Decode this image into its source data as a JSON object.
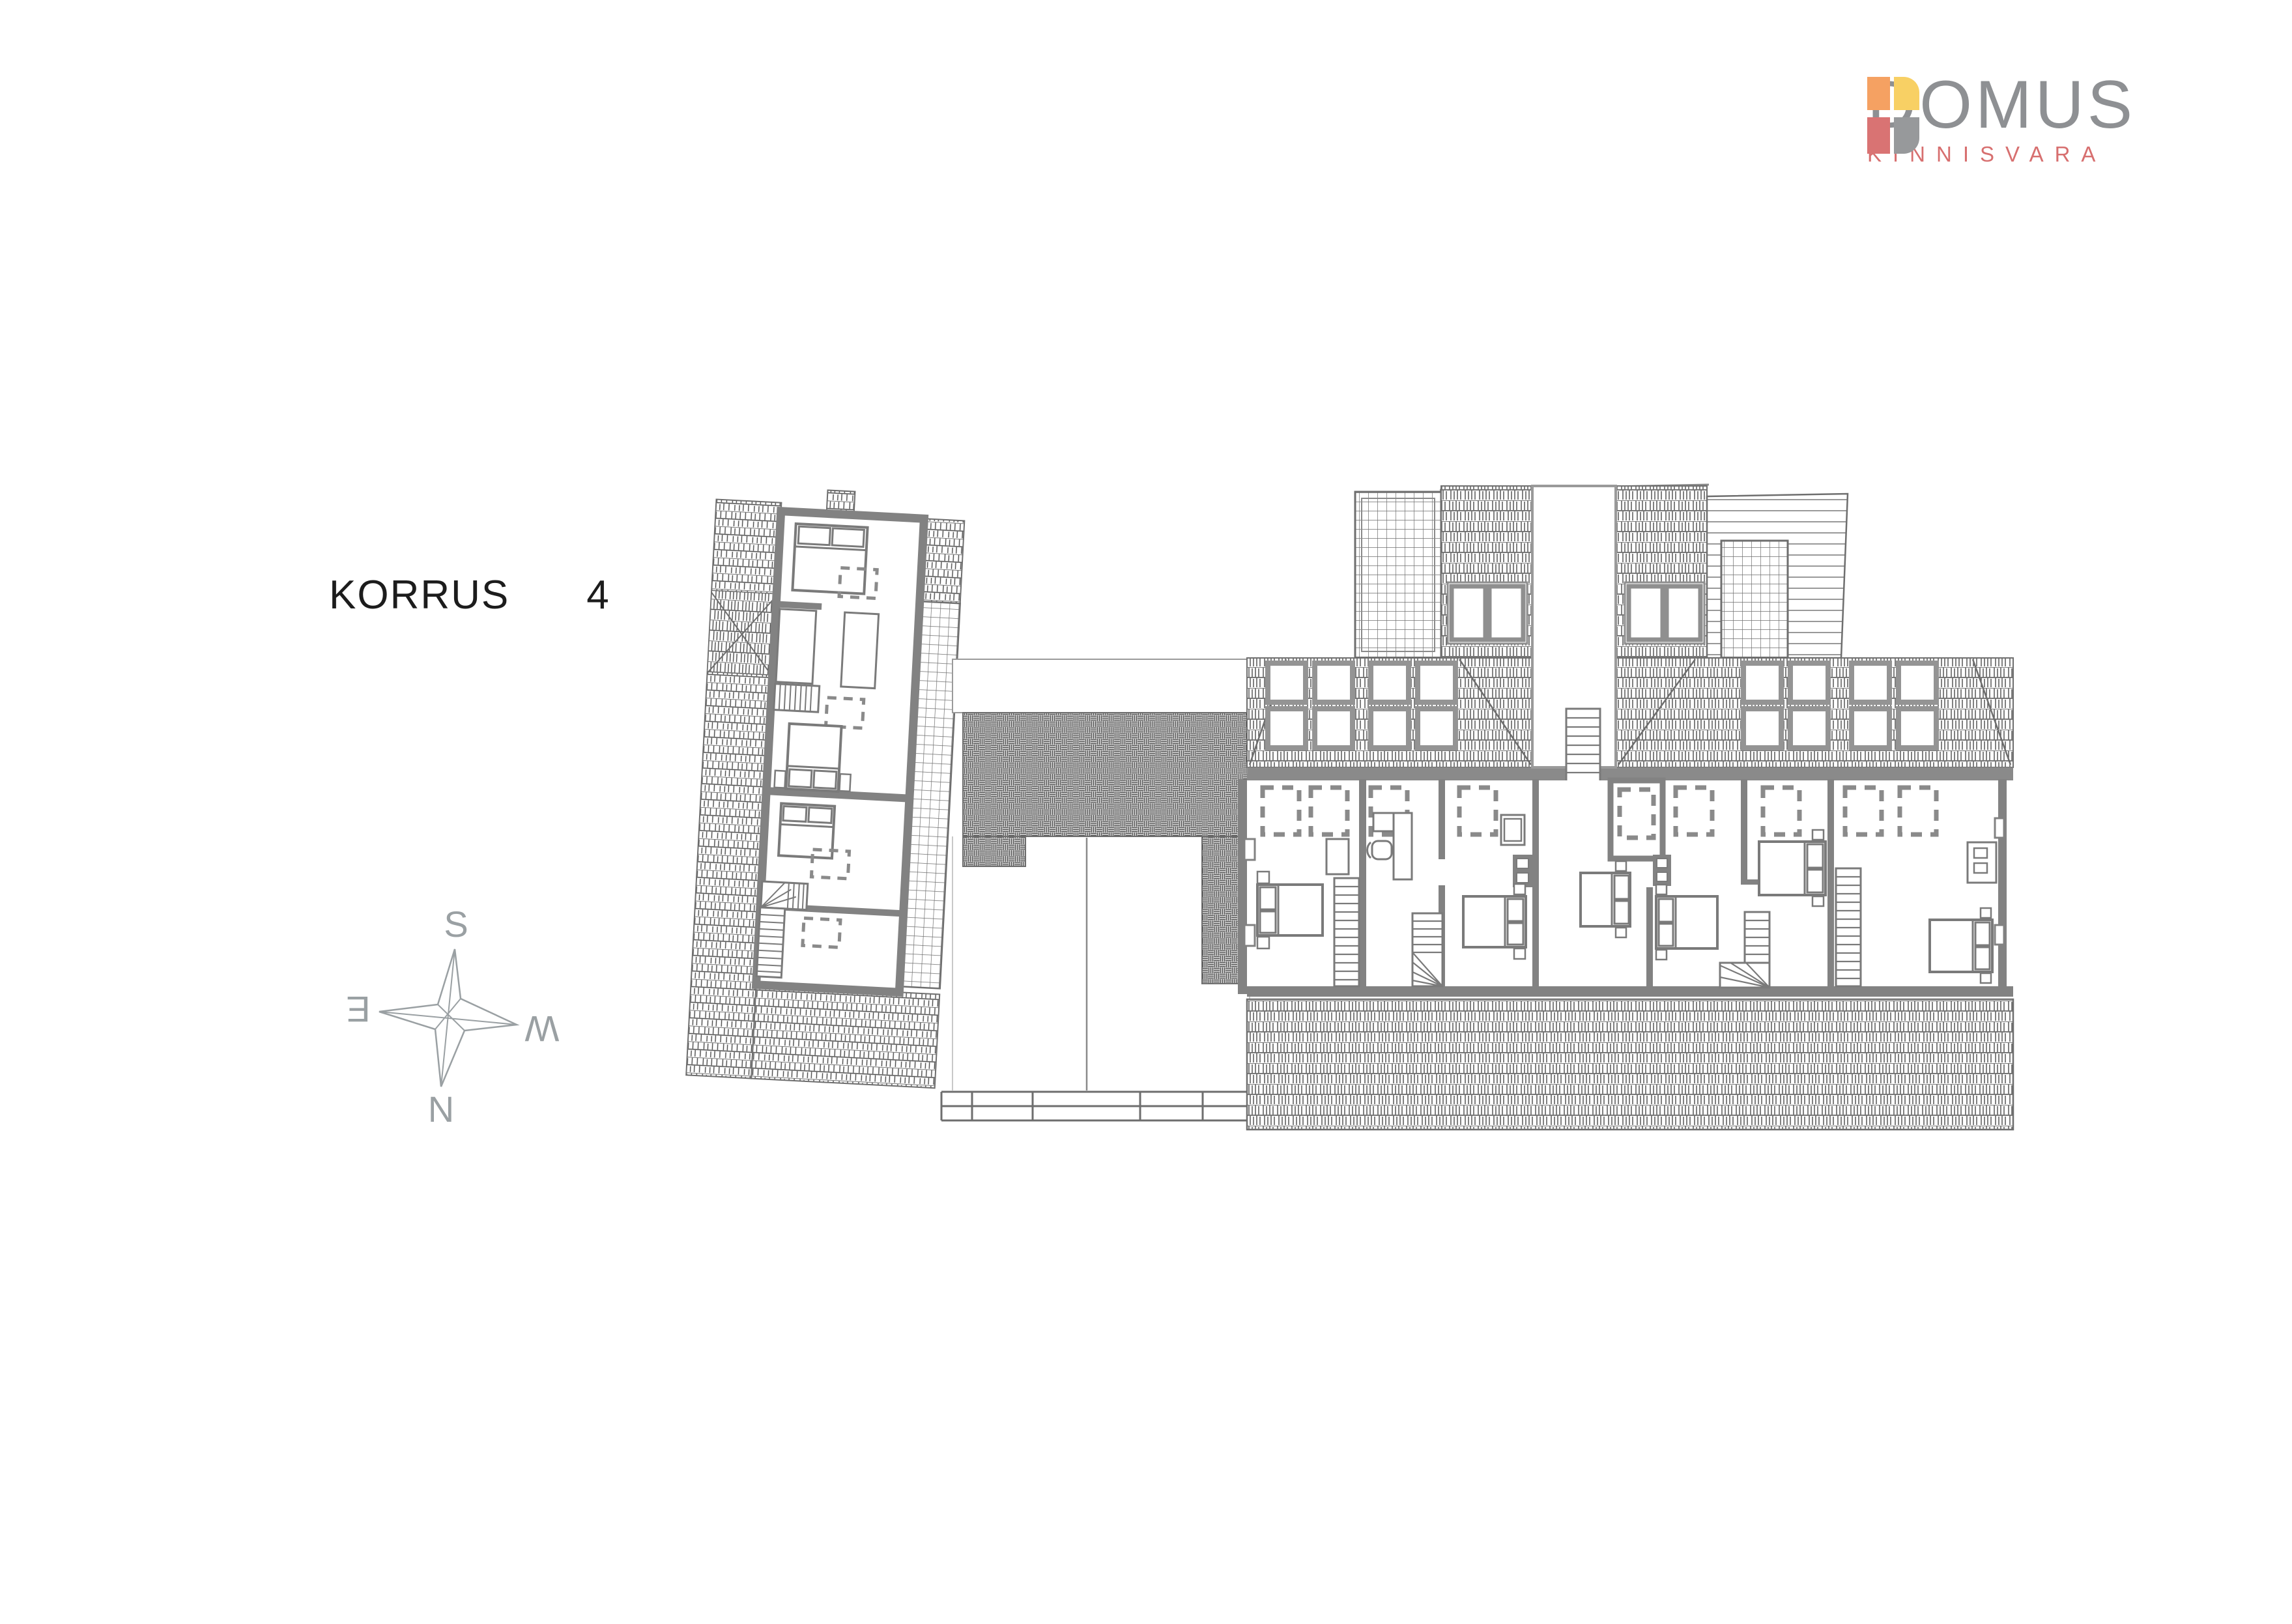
{
  "title": {
    "floor_label": "KORRUS",
    "floor_number": "4"
  },
  "logo": {
    "name": "DOMUS",
    "subtitle": "KINNISVARA",
    "name_color": "#8e9093",
    "subtitle_color": "#d76f6f",
    "colors": {
      "orange": "#f5a162",
      "yellow": "#f8d064",
      "red": "#d97373",
      "gray": "#97999b"
    }
  },
  "compass": {
    "south": "S",
    "west": "W",
    "north": "N",
    "east": "E"
  },
  "plan": {
    "wall_color": "#828282",
    "line_color": "#6e6e6e",
    "hatch_color": "#4a4a4a",
    "terrace_hatch_color": "#4e4e4e"
  }
}
